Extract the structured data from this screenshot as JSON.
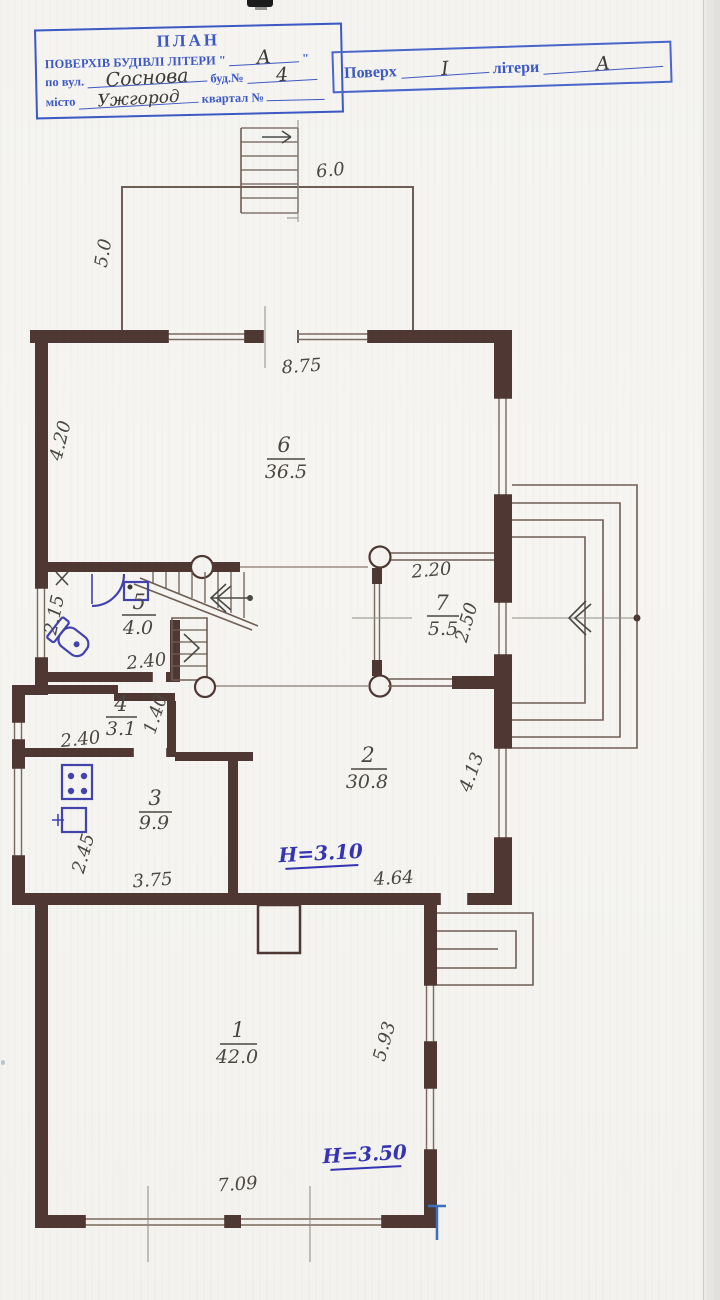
{
  "page": {
    "background": "#f3f2ee"
  },
  "stamp_main": {
    "title": "ПЛАН",
    "line2_label": "ПОВЕРХІВ БУДІВЛІ ЛІТЕРИ \"",
    "line2_value": "А",
    "line2_suffix": "\"",
    "line3_label1": "по вул.",
    "line3_value1": "Соснова",
    "line3_label2": "буд.№",
    "line3_value2": "4",
    "line4_label1": "місто",
    "line4_value1": "Ужгород",
    "line4_label2": "квартал №"
  },
  "stamp_floor": {
    "label1": "Поверх",
    "value1": "І",
    "label2": "літери",
    "value2": "А"
  },
  "plan": {
    "rooms": [
      {
        "num": "1",
        "area": "42.0"
      },
      {
        "num": "2",
        "area": "30.8"
      },
      {
        "num": "3",
        "area": "9.9"
      },
      {
        "num": "4",
        "area": "3.1"
      },
      {
        "num": "5",
        "area": "4.0"
      },
      {
        "num": "6",
        "area": "36.5"
      },
      {
        "num": "7",
        "area": "5.5"
      }
    ],
    "heights": {
      "room2": "Н=3.10",
      "room1": "Н=3.50"
    },
    "dims": {
      "terrace_width": "6.0",
      "terrace_depth": "5.0",
      "room6_top": "8.75",
      "room6_left": "4.20",
      "room7_top": "2.20",
      "room7_right": "2.50",
      "room5_left": "2.15",
      "room5_bottom": "2.40",
      "room4_width": "2.40",
      "room4_right": "1.40",
      "room3_left": "2.45",
      "room3_bottom": "3.75",
      "room2_bottom": "4.64",
      "room2_right": "4.13",
      "room1_bottom": "7.09",
      "room1_right": "5.93"
    }
  }
}
